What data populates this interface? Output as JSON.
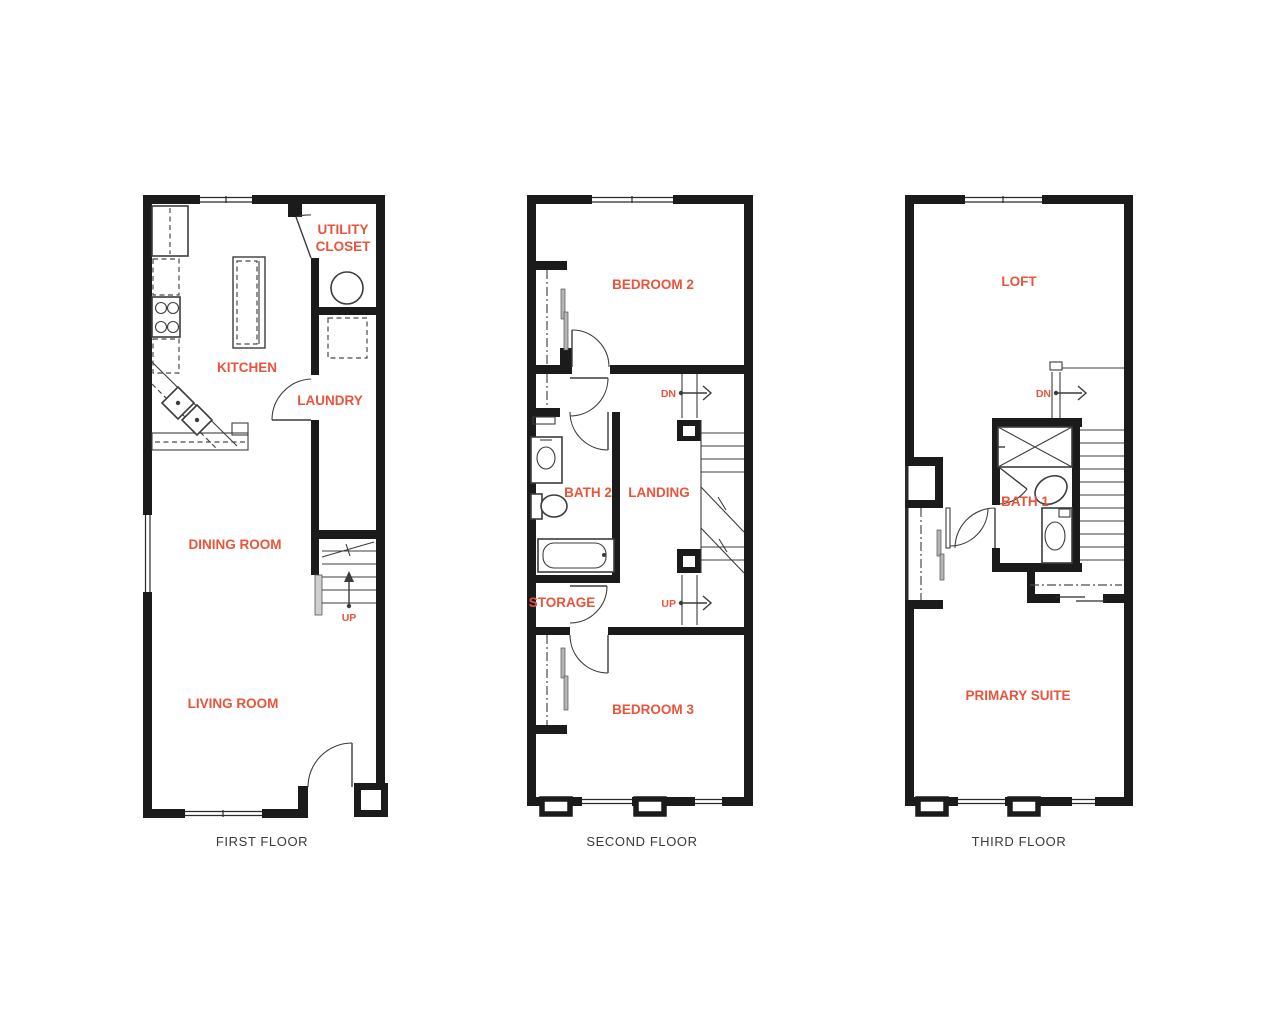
{
  "page": {
    "background": "#ffffff"
  },
  "colors": {
    "label_orange": "#E8543C",
    "wall_black": "#1b1b1b",
    "caption_gray": "#3a3a3a",
    "detail_gray": "#3c3c3c"
  },
  "floors": [
    {
      "caption": "FIRST FLOOR",
      "labels": {
        "utility_line1": "UTILITY",
        "utility_line2": "CLOSET",
        "kitchen": "KITCHEN",
        "laundry": "LAUNDRY",
        "dining_room": "DINING ROOM",
        "up": "UP",
        "living_room": "LIVING ROOM"
      }
    },
    {
      "caption": "SECOND FLOOR",
      "labels": {
        "bedroom2": "BEDROOM 2",
        "dn": "DN",
        "bath2": "BATH 2",
        "landing": "LANDING",
        "storage": "STORAGE",
        "up": "UP",
        "bedroom3": "BEDROOM 3"
      }
    },
    {
      "caption": "THIRD FLOOR",
      "labels": {
        "loft": "LOFT",
        "dn": "DN",
        "bath1": "BATH 1",
        "primary_suite": "PRIMARY SUITE"
      }
    }
  ]
}
